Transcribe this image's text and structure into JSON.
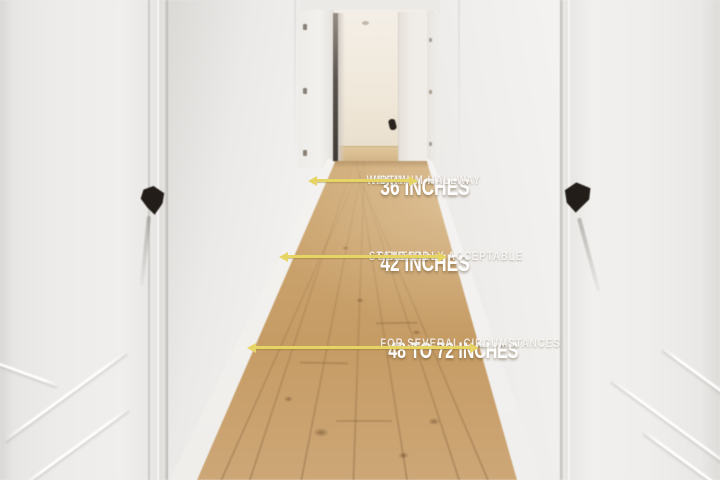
{
  "scene": {
    "description": "Bright hallway photograph: white panelled doors on the left and right with black handles, an open doorway at the far end, white walls and light oak wood flooring",
    "colors": {
      "walls": "#efeeec",
      "doors": "#ecebe9",
      "floor_wood_light": "#dcc194",
      "floor_wood_dark": "#c69c65",
      "door_handles": "#221d18"
    }
  },
  "overlay": {
    "accent_color": "#e6d465",
    "text_color": "#ffffff",
    "measurements": [
      {
        "value": "36 INCHES",
        "description_line1": "MINIMUM HALLWAY",
        "description_line2": "WIDTH",
        "arrow_icon": "double-headed-horizontal-arrow"
      },
      {
        "value": "42 INCHES",
        "description_line1": "GENERALLY ACCEPTABLE",
        "description_line2": "STANDARD",
        "arrow_icon": "double-headed-horizontal-arrow"
      },
      {
        "value": "48 TO 72 INCHES",
        "description_line1": "FOR SEVERAL CIRCUMSTANCES",
        "description_line2": "",
        "arrow_icon": "double-headed-horizontal-arrow"
      }
    ]
  }
}
